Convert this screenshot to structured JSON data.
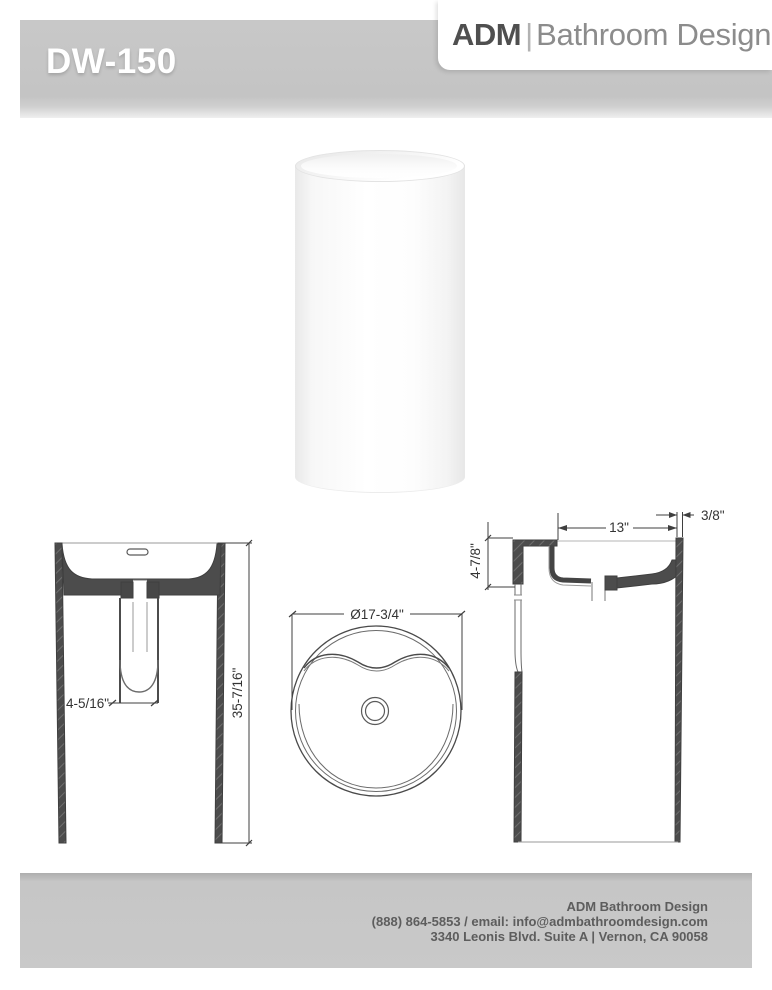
{
  "brand": {
    "name_bold": "ADM",
    "separator": "|",
    "name_light": "Bathroom Design"
  },
  "product": {
    "model": "DW-150",
    "render": "white-cylindrical-pedestal-sink"
  },
  "drawings": {
    "front_view": {
      "overall_height_label": "35-7/16\"",
      "drain_depth_label": "4-5/16\""
    },
    "top_view": {
      "diameter_label": "Ø17-3/4\""
    },
    "side_view": {
      "basin_width_label": "13\"",
      "wall_thickness_label": "3/8\"",
      "basin_depth_label": "4-7/8\""
    }
  },
  "footer": {
    "company": "ADM Bathroom Design",
    "contact": "(888) 864-5853 / email: info@admbathroomdesign.com",
    "address": "3340 Leonis Blvd. Suite A | Vernon, CA 90058"
  },
  "colors": {
    "banner_gray": "#c4c4c4",
    "section_fill": "#4c4c4c",
    "line_dark": "#3f3f3f",
    "line_light": "#9a9a9a",
    "text_dark": "#5d5d5d"
  }
}
